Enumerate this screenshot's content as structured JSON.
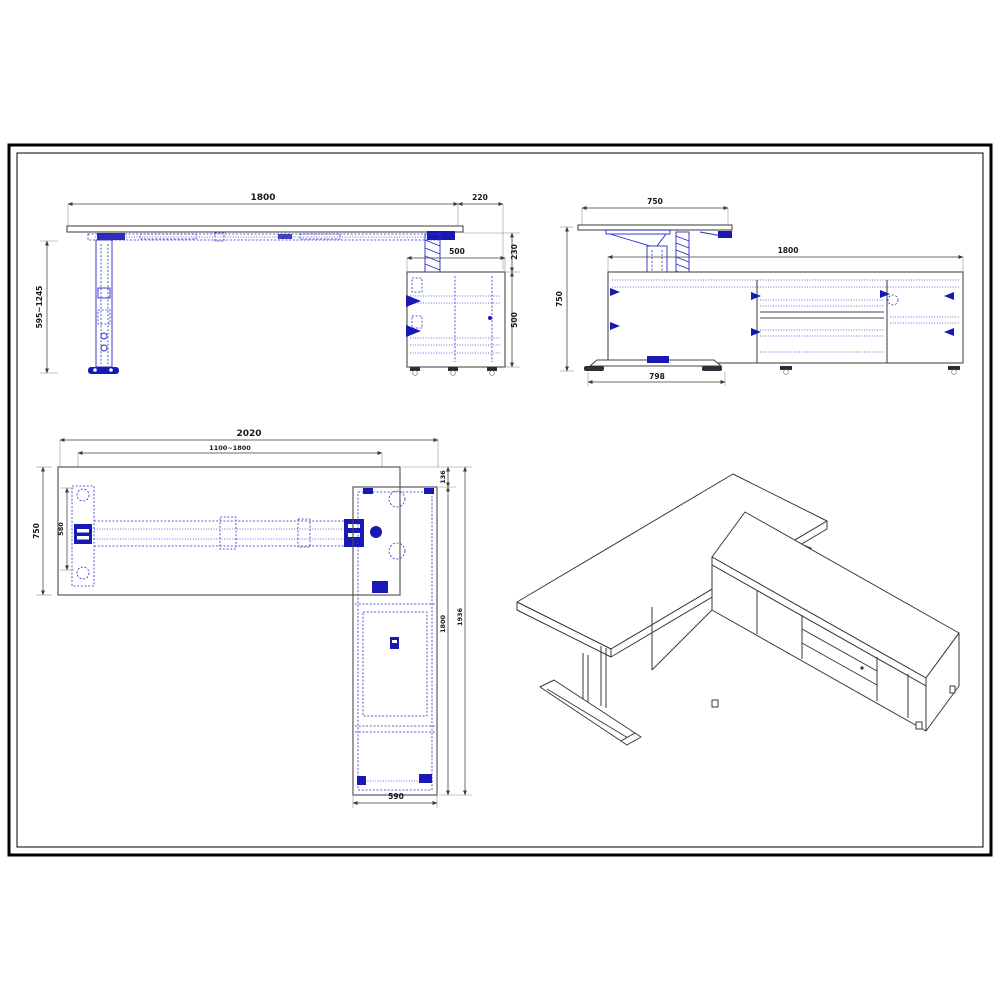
{
  "sheet": {
    "front_view": {
      "dims": {
        "desk_width": "1800",
        "cabinet_overhang": "220",
        "height_range": "595~1245",
        "cabinet_width": "500",
        "desktop_to_cabinet": "230",
        "cabinet_height": "500"
      }
    },
    "side_view": {
      "dims": {
        "desk_depth": "750",
        "cabinet_length": "1800",
        "desk_height": "750",
        "foot_length": "798"
      }
    },
    "plan_view": {
      "dims": {
        "overall_width": "2020",
        "frame_width_range": "1100~1800",
        "desk_depth": "750",
        "frame_depth": "580",
        "rear_offset": "136",
        "cabinet_length": "1800",
        "overall_depth": "1936",
        "cabinet_depth": "590"
      }
    },
    "colors": {
      "outline": "#4a4a4a",
      "dimension": "#3c3c3c",
      "mechanism_blue": "#2a2ac8",
      "mechanism_blue_dark": "#1818b4",
      "border": "#000000"
    }
  }
}
